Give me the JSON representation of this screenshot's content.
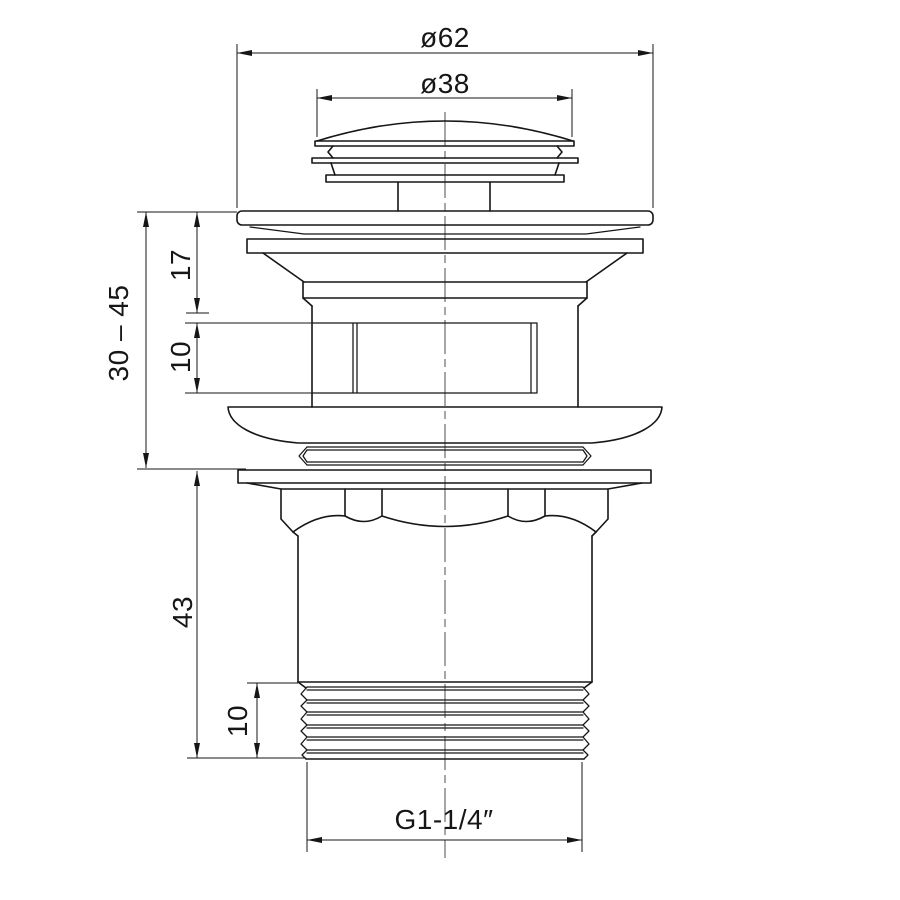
{
  "page": {
    "background": "#ffffff",
    "ink": "#161616"
  },
  "drawing_kind": "technical dimension drawing, side elevation",
  "dims": {
    "dia_top": "ø62",
    "dia_cap": "ø38",
    "flange_to_step": "17",
    "slot_height": "10",
    "adjust_range": "30 – 45",
    "body_length": "43",
    "thread_length": "10",
    "thread_spec": "G1-1/4″"
  }
}
